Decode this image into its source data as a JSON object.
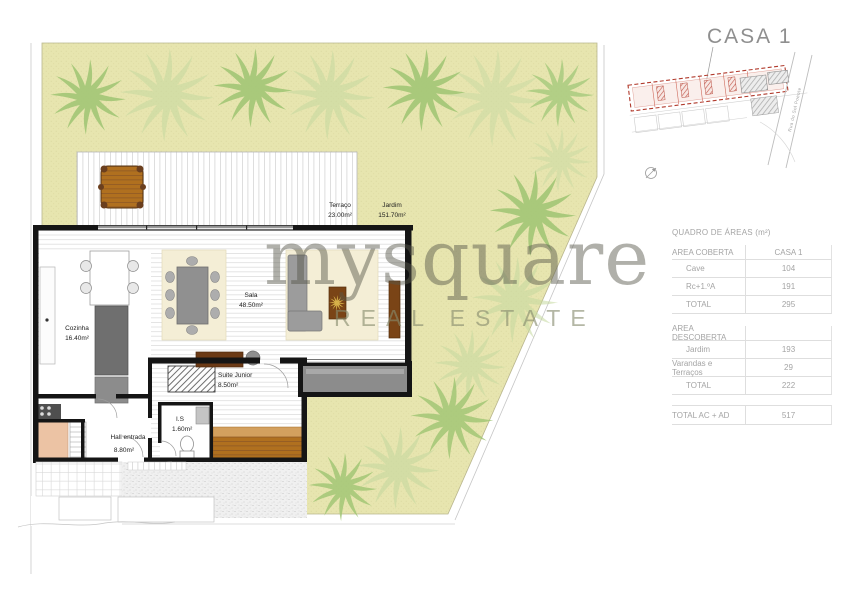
{
  "watermark": {
    "brand": "mysquare",
    "tagline": "REAL ESTATE"
  },
  "site_plan": {
    "title": "CASA 1",
    "road_label": "Rua do Sol Poente"
  },
  "plan": {
    "rooms": [
      {
        "name": "Terraço",
        "area": "23.00m²"
      },
      {
        "name": "Jardim",
        "area": "151.70m²"
      },
      {
        "name": "Cozinha",
        "area": "16.40m²"
      },
      {
        "name": "Sala",
        "area": "48.50m²"
      },
      {
        "name": "Suite Junior",
        "area": "8.50m²"
      },
      {
        "name": "I.S",
        "area": "1.60m²"
      },
      {
        "name": "Hall entrada",
        "area": "8.80m²"
      }
    ]
  },
  "areas_table": {
    "title": "QUADRO DE ÁREAS (m²)",
    "covered_header": "AREA COBERTA",
    "unit_header": "CASA 1",
    "covered_rows": [
      {
        "label": "Cave",
        "value": "104"
      },
      {
        "label": "Rc+1.ºA",
        "value": "191"
      },
      {
        "label": "TOTAL",
        "value": "295"
      }
    ],
    "uncovered_header": "AREA DESCOBERTA",
    "uncovered_rows": [
      {
        "label": "Jardim",
        "value": "193"
      },
      {
        "label": "Varandas e Terraços",
        "value": "29"
      },
      {
        "label": "TOTAL",
        "value": "222"
      }
    ],
    "grand_total": {
      "label": "TOTAL AC + AD",
      "value": "517"
    }
  },
  "colors": {
    "garden_green": "#e7e5af",
    "palm_green": "#9fc573",
    "lot_red": "#b13a2c",
    "wall_black": "#151515",
    "wood_brown": "#b0701f"
  }
}
